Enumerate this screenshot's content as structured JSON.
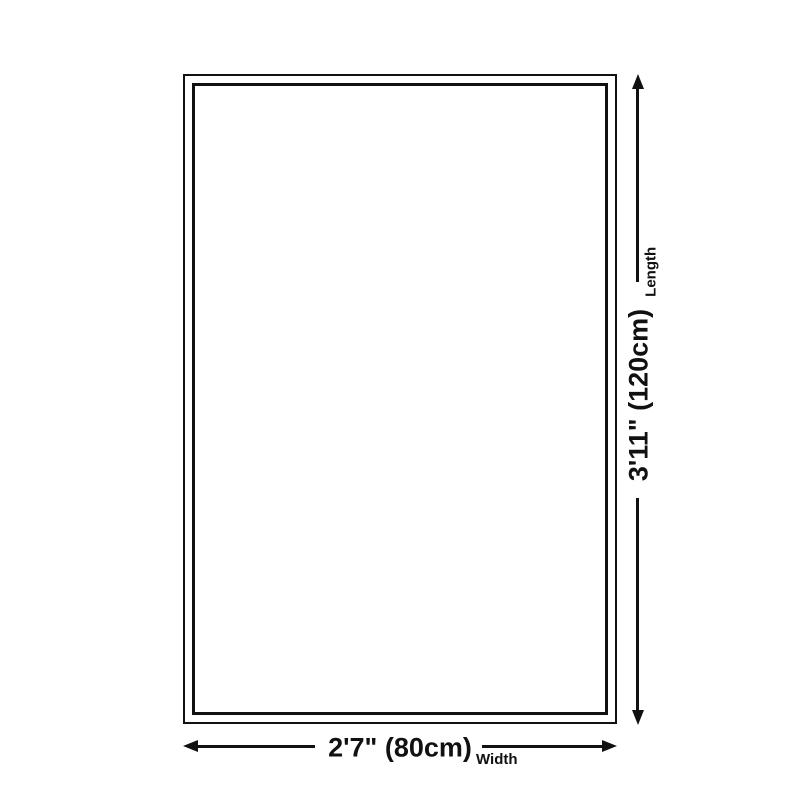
{
  "diagram": {
    "type": "product-size-diagram",
    "background_color": "#ffffff",
    "line_color": "#111111",
    "shape": "rectangle-with-double-border",
    "dimensions": {
      "length": {
        "value": "3'11\" (120cm)",
        "label": "Length",
        "orientation": "vertical",
        "arrow": "double-headed"
      },
      "width": {
        "value": "2'7\" (80cm)",
        "label": "Width",
        "orientation": "horizontal",
        "arrow": "double-headed"
      }
    }
  }
}
